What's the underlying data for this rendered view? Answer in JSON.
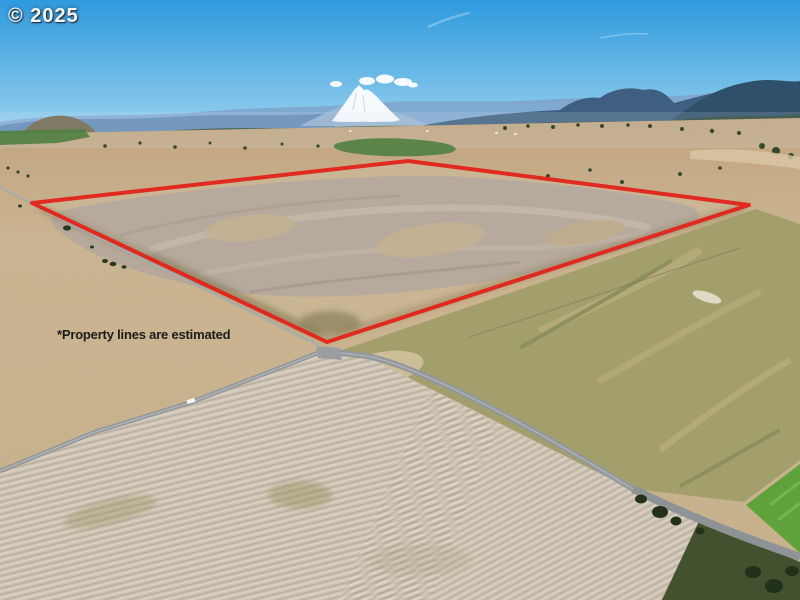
{
  "watermark": {
    "text": "© 2025"
  },
  "disclaimer": {
    "text": "*Property lines are estimated"
  },
  "boundary": {
    "points": "32,203 408,161 749,205 327,342",
    "color": "#e2241b",
    "stroke_width": "4"
  },
  "colors": {
    "sky_top": "#2f9ade",
    "sky_horizon": "#9ed4ef",
    "snow_peak": "#f7fafd",
    "haze_ridge": "#7fa3cc",
    "slate_ridge": "#3f5f80",
    "far_right_ridge": "#2f4f6b",
    "forest": "#2c4734",
    "plain_light": "#ccb694",
    "plain_dark": "#c2a47e",
    "green_field": "#4e8040",
    "lakebed_gray": "#b5aa9e",
    "olive_grass": "#a3a06c",
    "plowed_field": "#cfc5b6",
    "road_gray": "#94999c",
    "bright_green_field": "#5ea339",
    "scrub_green": "#41502c"
  }
}
